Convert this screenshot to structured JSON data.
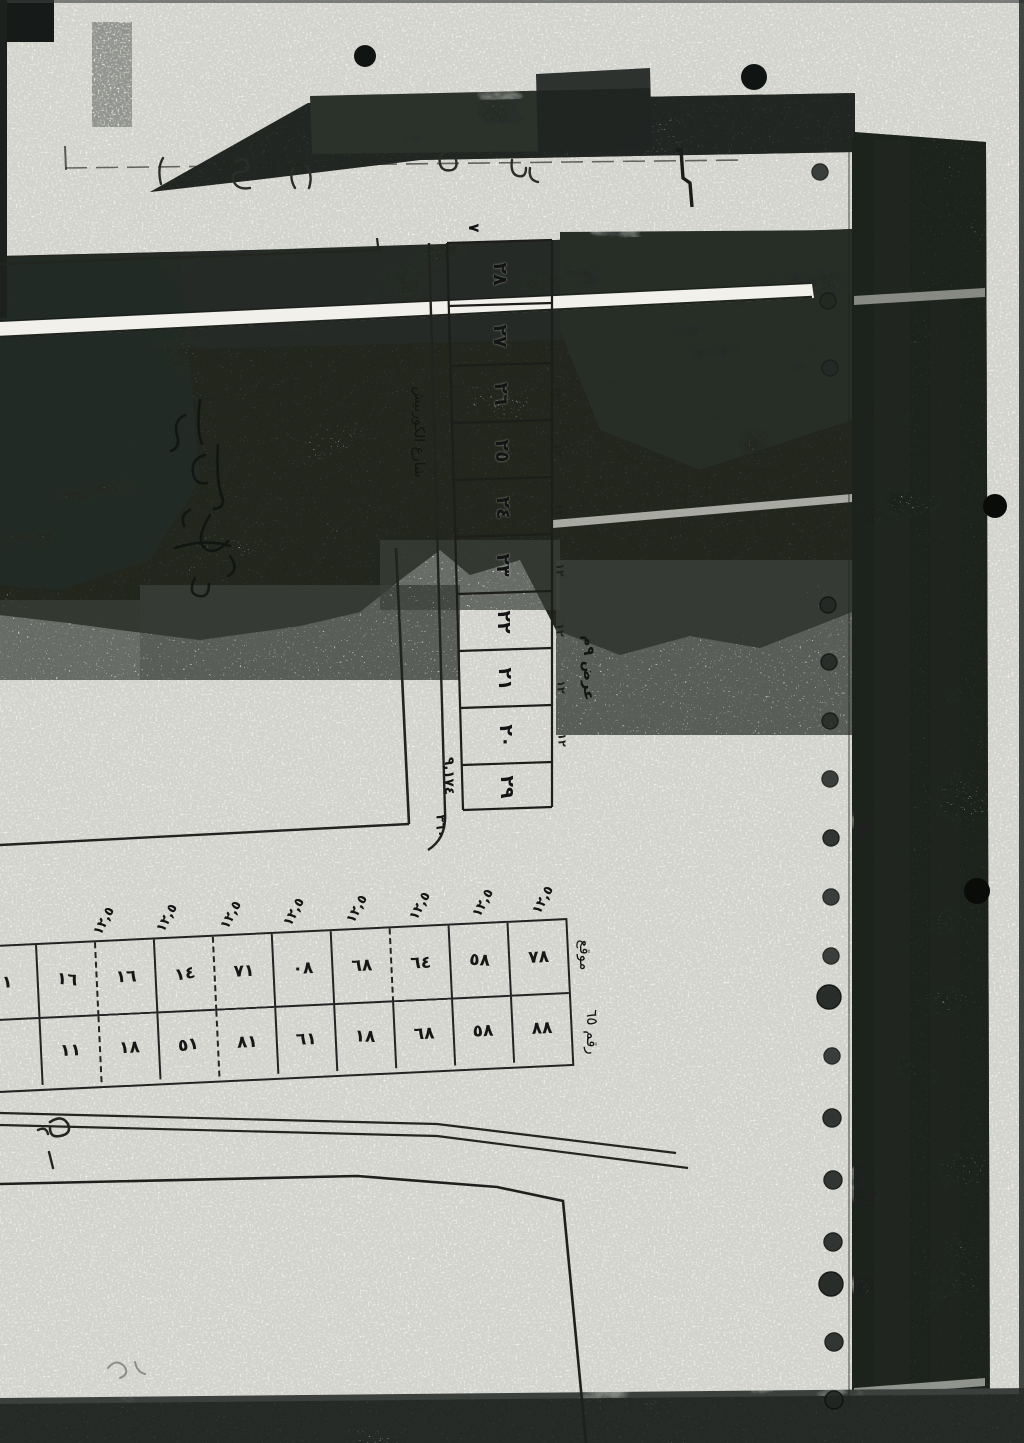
{
  "strip": {
    "plot_numbers": [
      "٢٨",
      "٢٧",
      "٢٦",
      "٢٥",
      "٢٤",
      "٢٣",
      "٢٢",
      "٢١",
      "٢٠",
      "٢٩"
    ],
    "side_dim_mark": "١٢",
    "area_note": "٩,١٧٤",
    "count_note": "٣٦٠",
    "street_label": "شارع الكورنيش",
    "check_mark": "٧",
    "width_note": "عرض ٩م"
  },
  "table": {
    "dim_label": "١٢,٥",
    "row_top": [
      "١",
      "١٦",
      "١٦",
      "١٤",
      "٧١",
      "٠٨",
      "٦٨",
      "٦٤",
      "٥٨",
      "٧٨"
    ],
    "row_bottom": [
      "",
      "١١",
      "١٨",
      "٥١",
      "٨١",
      "٦١",
      "١٨",
      "٦٨",
      "٥٨",
      "٨٨"
    ]
  },
  "annotations": {
    "right_of_table_1": "موقع",
    "right_of_table_2": "رقم ٦٥"
  },
  "colors": {
    "paper": "#f1f0ea",
    "ink": "#1c1c1c",
    "toner_dark": "#2e342f"
  }
}
